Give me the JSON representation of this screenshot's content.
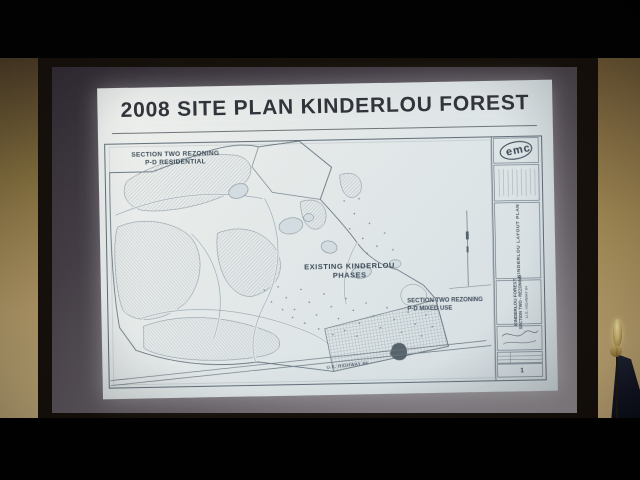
{
  "photo": {
    "slide_title": "2008 SITE PLAN KINDERLOU FOREST",
    "plan_labels": {
      "section_two_residential": [
        "SECTION TWO REZONING",
        "P-D RESIDENTIAL"
      ],
      "existing_phases": [
        "EXISTING KINDERLOU",
        "PHASES"
      ],
      "section_two_mixed_use": [
        "SECTION TWO REZONING",
        "P-D MIXED USE"
      ],
      "highway": "U.S. HIGHWAY 84"
    },
    "title_block": {
      "logo_text": "emc",
      "drawing_name": "KINDERLOU LAYOUT PLAN",
      "project_line1": "KINDERLOU FOREST",
      "project_line2": "SECTION TWO - REZONING",
      "project_line3": "U.S. HIGHWAY 84",
      "sheet_number": "1"
    },
    "colors": {
      "slide_bg": "#e2e7e8",
      "plan_ink": "#5e6d7a",
      "label_ink": "#3d4c58",
      "wall_tan": "#b59c6a",
      "frame_dark": "#17110c",
      "screen_gray": "#554f57",
      "flag_navy": "#141827",
      "finial_gold": "#dfc478"
    }
  }
}
